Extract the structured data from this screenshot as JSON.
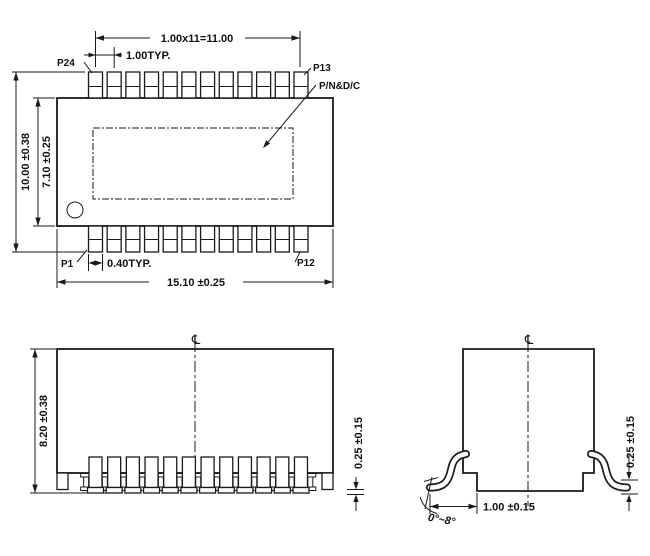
{
  "drawing": {
    "top_view": {
      "p24": "P24",
      "p13": "P13",
      "p1": "P1",
      "p12": "P12",
      "pn_dc": "P/N&D/C",
      "dim_row_pitch_total": "1.00x11=11.00",
      "dim_pitch": "1.00TYP.",
      "dim_overall_height": "10.00 ±0.38",
      "dim_body_height": "7.10 ±0.25",
      "dim_lead_width": "0.40TYP.",
      "dim_overall_width": "15.10 ±0.25"
    },
    "front_view": {
      "dim_height": "8.20 ±0.38",
      "dim_standoff": "0.25 ±0.15",
      "centerline_symbol": "℄"
    },
    "side_view": {
      "dim_foot_length": "1.00 ±0.15",
      "dim_standoff": "0.25 ±0.15",
      "dim_angle": "0°~8°",
      "centerline_symbol": "℄"
    }
  }
}
